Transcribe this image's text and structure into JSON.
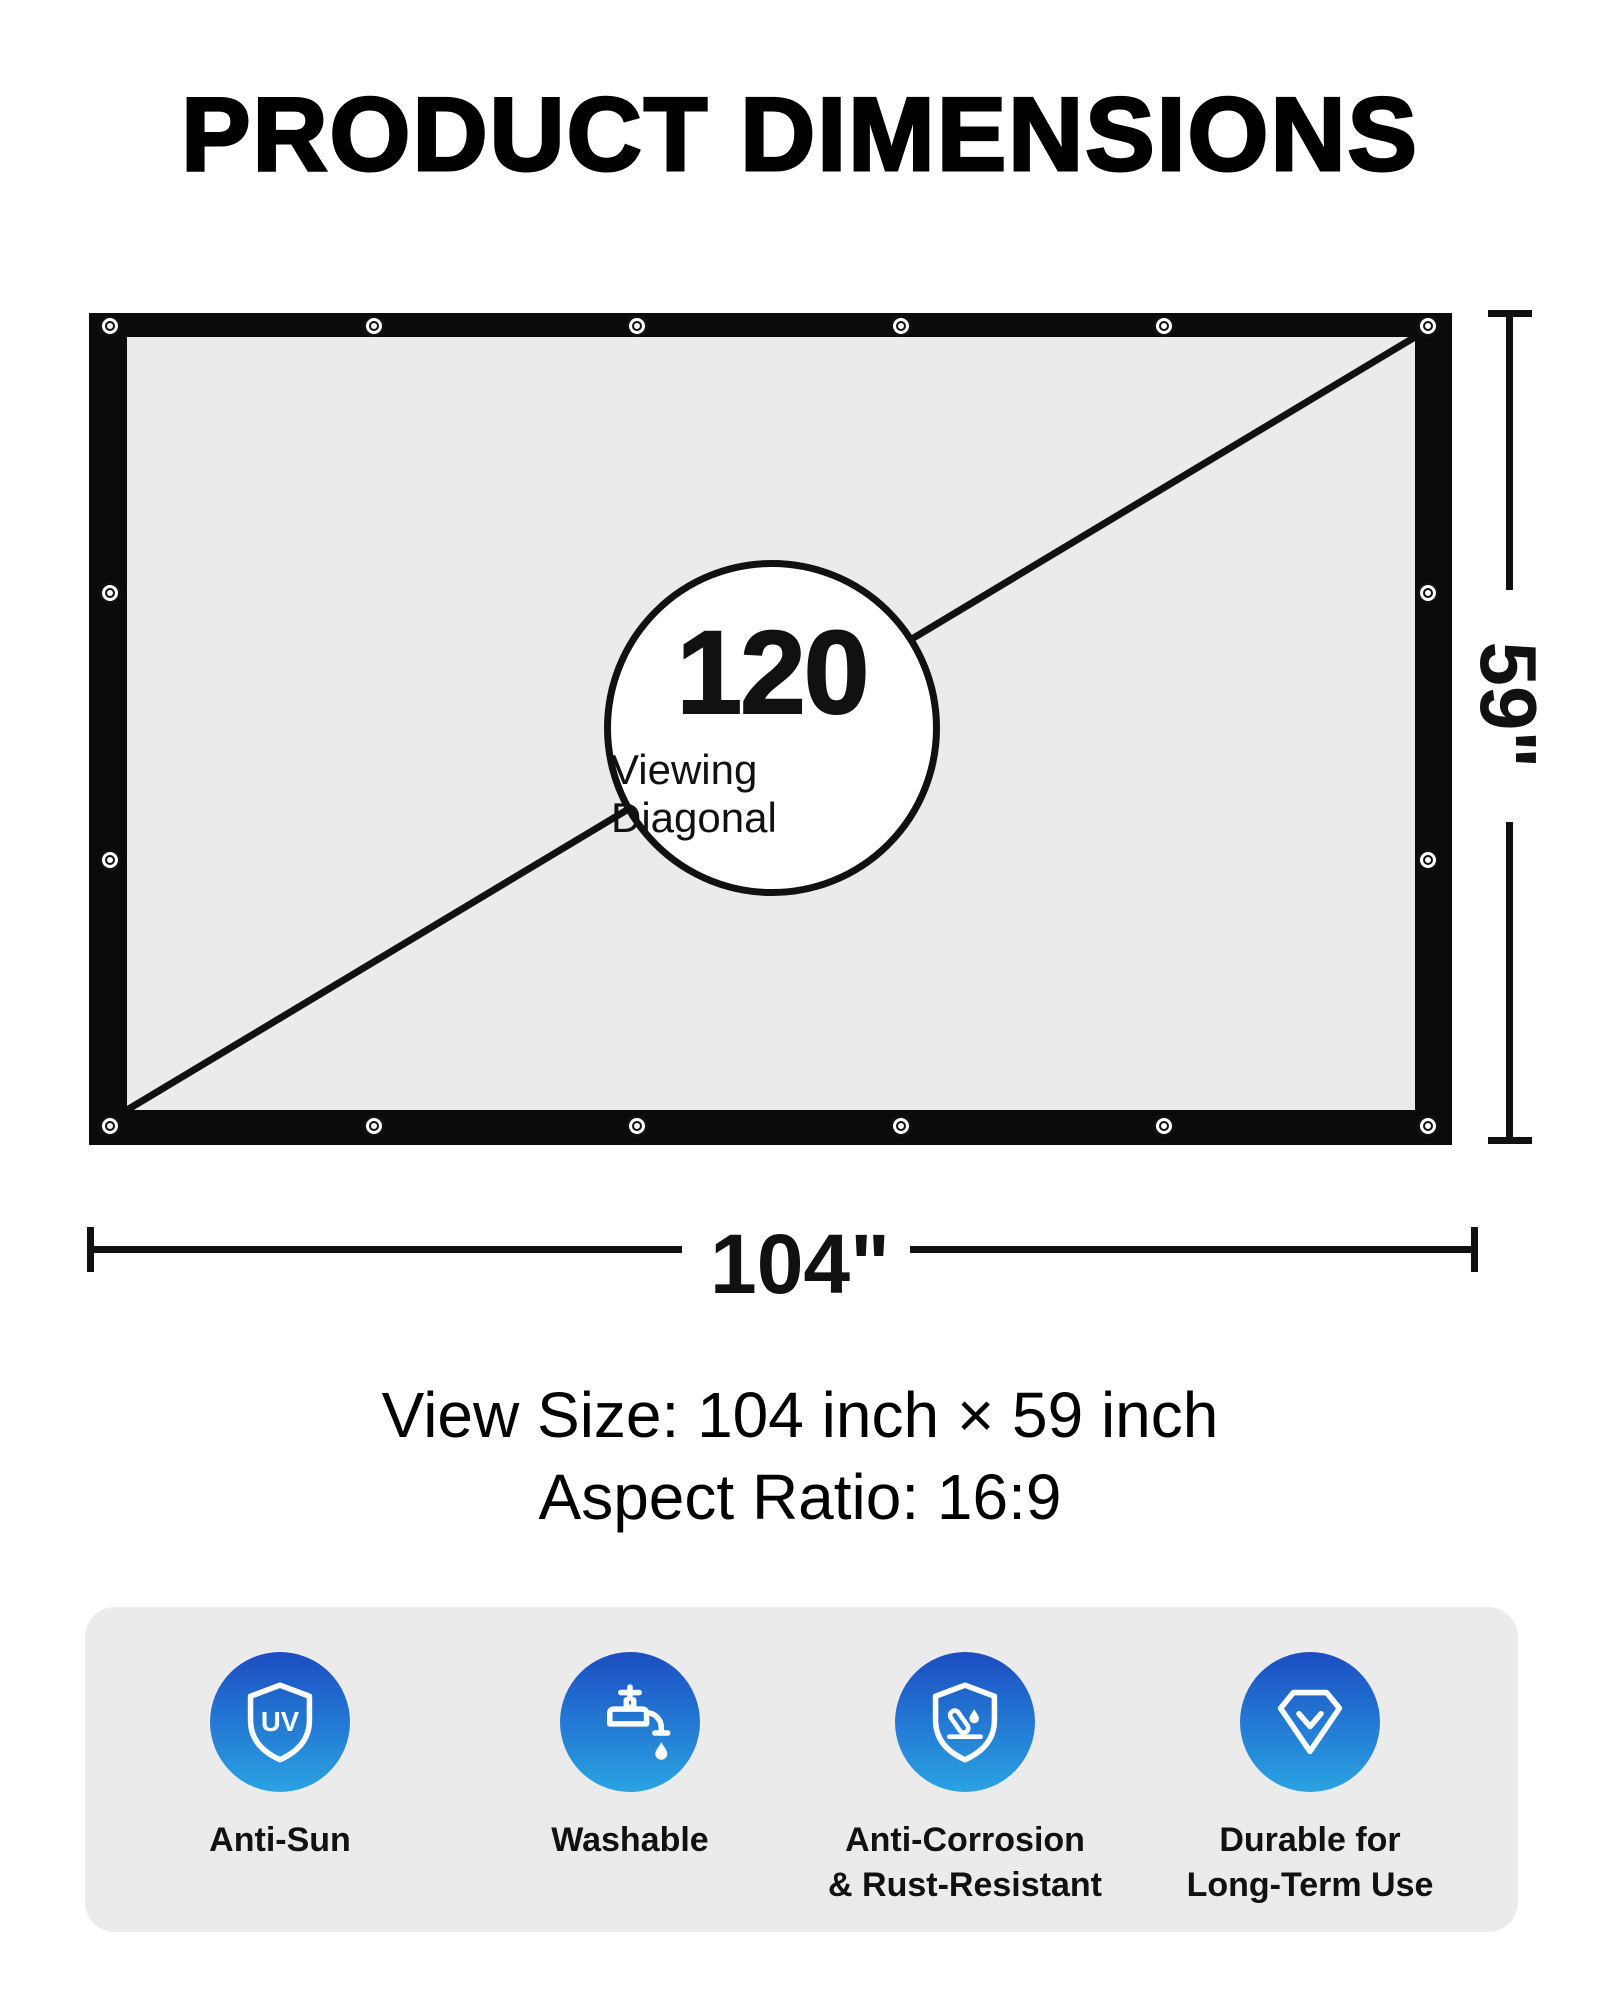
{
  "title": "PRODUCT DIMENSIONS",
  "diagram": {
    "diagonal_value": "120",
    "diagonal_label": "Viewing Diagonal",
    "height_label": "59\"",
    "width_label": "104\""
  },
  "specs": {
    "view_size": "View Size: 104 inch × 59 inch",
    "aspect_ratio": "Aspect Ratio: 16:9"
  },
  "features": [
    {
      "icon": "uv-shield-icon",
      "icon_text": "UV",
      "line1": "Anti-Sun",
      "line2": ""
    },
    {
      "icon": "faucet-icon",
      "line1": "Washable",
      "line2": ""
    },
    {
      "icon": "corrosion-shield-icon",
      "line1": "Anti-Corrosion",
      "line2": "& Rust-Resistant"
    },
    {
      "icon": "diamond-check-icon",
      "line1": "Durable for",
      "line2": "Long-Term Use"
    }
  ],
  "colors": {
    "icon_gradient_top": "#1c4dc2",
    "icon_gradient_bottom": "#2aa3e3",
    "screen_border": "#0b0b0b",
    "panel_bg": "#ebebeb"
  }
}
